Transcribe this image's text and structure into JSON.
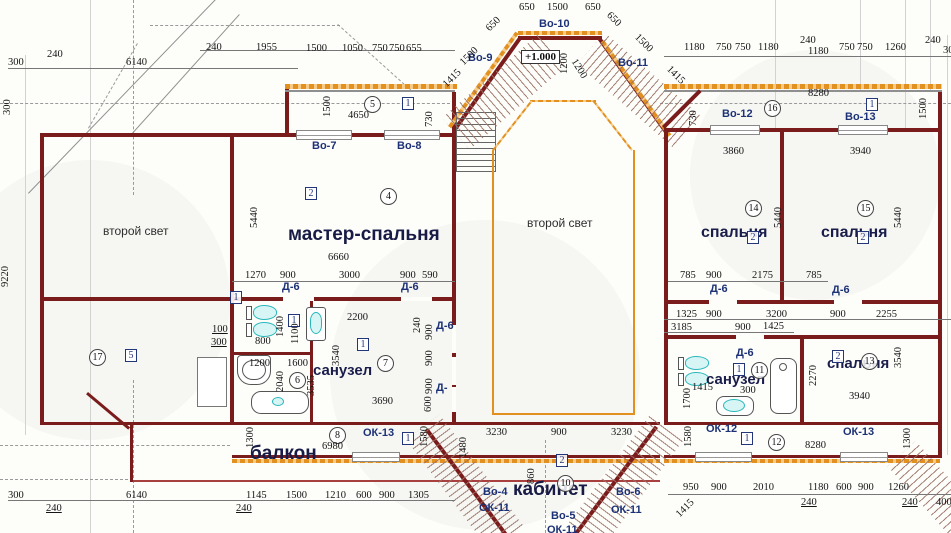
{
  "drawing": {
    "elevation_mark": "+1.000",
    "rooms": {
      "second_light": "второй свет",
      "master": "мастер-спальня",
      "bedroom": "спальня",
      "bath": "санузел",
      "balcony": "балкон",
      "office": "кабинет"
    },
    "openings": {
      "vo4": "Во-4",
      "vo5": "Во-5",
      "vo6": "Во-6",
      "vo7": "Во-7",
      "vo8": "Во-8",
      "vo9": "Во-9",
      "vo10": "Во-10",
      "vo11": "Во-11",
      "vo12": "Во-12",
      "vo13": "Во-13",
      "ok11": "ОК-11",
      "ok12": "ОК-12",
      "ok13": "ОК-13",
      "d6": "Д-6",
      "d_partial": "Д-"
    },
    "markers": {
      "m1": "1",
      "m2": "2",
      "m4": "4",
      "m5": "5",
      "m6": "6",
      "m7": "7",
      "m8": "8",
      "m10": "10",
      "m11": "11",
      "m12": "12",
      "m13": "13",
      "m14": "14",
      "m15": "15",
      "m16": "16",
      "m17": "17"
    },
    "dims": {
      "tl": [
        "300",
        "240",
        "6140",
        "240",
        "1955",
        "1500",
        "1050",
        "750",
        "750",
        "655"
      ],
      "tlv": [
        "300",
        "9220"
      ],
      "band": [
        "1500",
        "4650",
        "730"
      ],
      "bay": [
        "650",
        "1500",
        "650",
        "650",
        "1500",
        "650",
        "1500",
        "1200",
        "1200",
        "1415",
        "1415"
      ],
      "tr": [
        "1180",
        "750",
        "750",
        "1180",
        "240",
        "1180",
        "750",
        "750",
        "1260",
        "240",
        "300",
        "8280",
        "730",
        "1500"
      ],
      "master": [
        "5440",
        "6660",
        "1270",
        "900",
        "3000",
        "900",
        "590"
      ],
      "r14": [
        "3860",
        "5440",
        "785",
        "900",
        "2175",
        "785"
      ],
      "r15": [
        "3940",
        "5440"
      ],
      "corr": [
        "1325",
        "900",
        "3200",
        "900",
        "2255",
        "3185",
        "900",
        "1425"
      ],
      "bathl": [
        "100",
        "300",
        "800",
        "1400",
        "1100",
        "1200",
        "1600",
        "2040",
        "3535",
        "2200",
        "3540",
        "3690"
      ],
      "dcol": [
        "240",
        "900",
        "900",
        "900",
        "600"
      ],
      "balc": [
        "1300",
        "6980",
        "1580",
        "1480",
        "300",
        "6140",
        "240",
        "240",
        "1145",
        "1500",
        "1210",
        "600",
        "900",
        "1305"
      ],
      "office": [
        "3230",
        "900",
        "3230",
        "860"
      ],
      "bathr": [
        "1700",
        "1415",
        "300",
        "2270",
        "3540",
        "3940"
      ],
      "br": [
        "1580",
        "8280",
        "1300",
        "950",
        "900",
        "2010",
        "240",
        "1180",
        "600",
        "900",
        "1260",
        "240",
        "400",
        "1415"
      ]
    },
    "colors": {
      "wall": "#7a1c1c",
      "insulation": "#e2901f",
      "label": "#1d3276",
      "fixture": "#2ab7bb"
    }
  }
}
